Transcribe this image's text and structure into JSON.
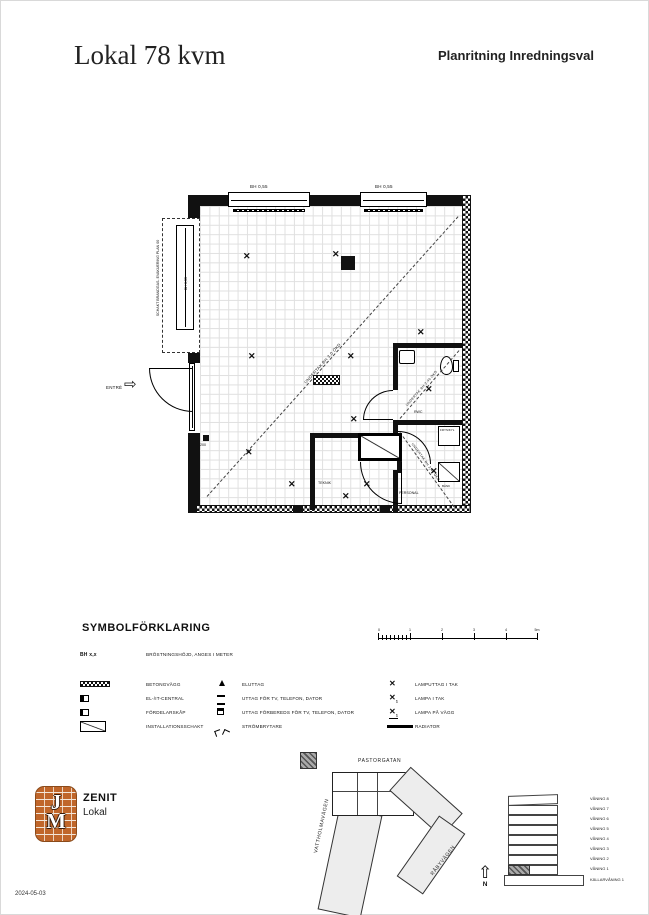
{
  "header": {
    "title": "Lokal 78 kvm",
    "subtitle": "Planritning Inredningsval"
  },
  "plan": {
    "bh_window_1": "BH 0,55",
    "bh_window_2": "BH 0,55",
    "bh_window_left": "BH 0,55",
    "schakt_label": "SCHAKT BRANDGAS- EVAKUERING PLAN 00",
    "entre_label": "ENTRÉ",
    "undertak_main": "UNDERTAK BH 3,0 ÖKD",
    "undertak_rwc": "UNDERTAK BH 2,40 ÖKD",
    "undertak_personal": "UNDERTAK BH 2,40 ÖKD",
    "rooms": {
      "teknik": "TEKNIK",
      "rwc": "RWC",
      "personal": "PERSONAL"
    },
    "fixtures": {
      "frys": "FRYS/KYL",
      "bank": "BÄNK",
      "el_note": "200"
    }
  },
  "legend": {
    "title": "SYMBOLFÖRKLARING",
    "bh_symbol": "BH x,x",
    "bh_label": "BRÖSTNINGSHÖJD, ANGES I METER",
    "col1": [
      {
        "label": "BETONGVÄGG"
      },
      {
        "label": "EL-/IT-CENTRAL"
      },
      {
        "label": "FÖRDELARSKÅP"
      },
      {
        "label": "INSTALLATIONSSCHAKT"
      }
    ],
    "col2": [
      {
        "label": "ELUTTAG"
      },
      {
        "label": "UTTAG FÖR TV, TELEFON, DATOR"
      },
      {
        "label": "UTTAG FÖRBEREDS FÖR TV, TELEFON, DATOR"
      },
      {
        "label": "STRÖMBRYTARE"
      }
    ],
    "col3": [
      {
        "label": "LAMPUTTAG I TAK"
      },
      {
        "label": "LAMPA I TAK"
      },
      {
        "label": "LAMPA PÅ VÄGG"
      },
      {
        "label": "RADIATOR"
      }
    ]
  },
  "scalebar": {
    "ticks": [
      "0",
      "1",
      "2",
      "3",
      "4",
      "5m"
    ]
  },
  "footer": {
    "logo_top": "J",
    "logo_bottom": "M",
    "project": "ZENIT",
    "type": "Lokal",
    "date": "2024-05-03"
  },
  "siteplan": {
    "street_top": "PASTORGATAN",
    "street_left": "VATTHOLMAVÄGEN",
    "street_right": "RÅBYVÄGEN",
    "north": "N"
  },
  "elevation": {
    "floors": [
      "VÅNING 8",
      "VÅNING 7",
      "VÅNING 6",
      "VÅNING 5",
      "VÅNING 4",
      "VÅNING 3",
      "VÅNING 2",
      "VÅNING 1",
      "KÄLLARVÅNING 1"
    ]
  },
  "icons": {
    "lamp": "✕",
    "north_arrow": "⇧",
    "entre_arrow": "⇨"
  }
}
